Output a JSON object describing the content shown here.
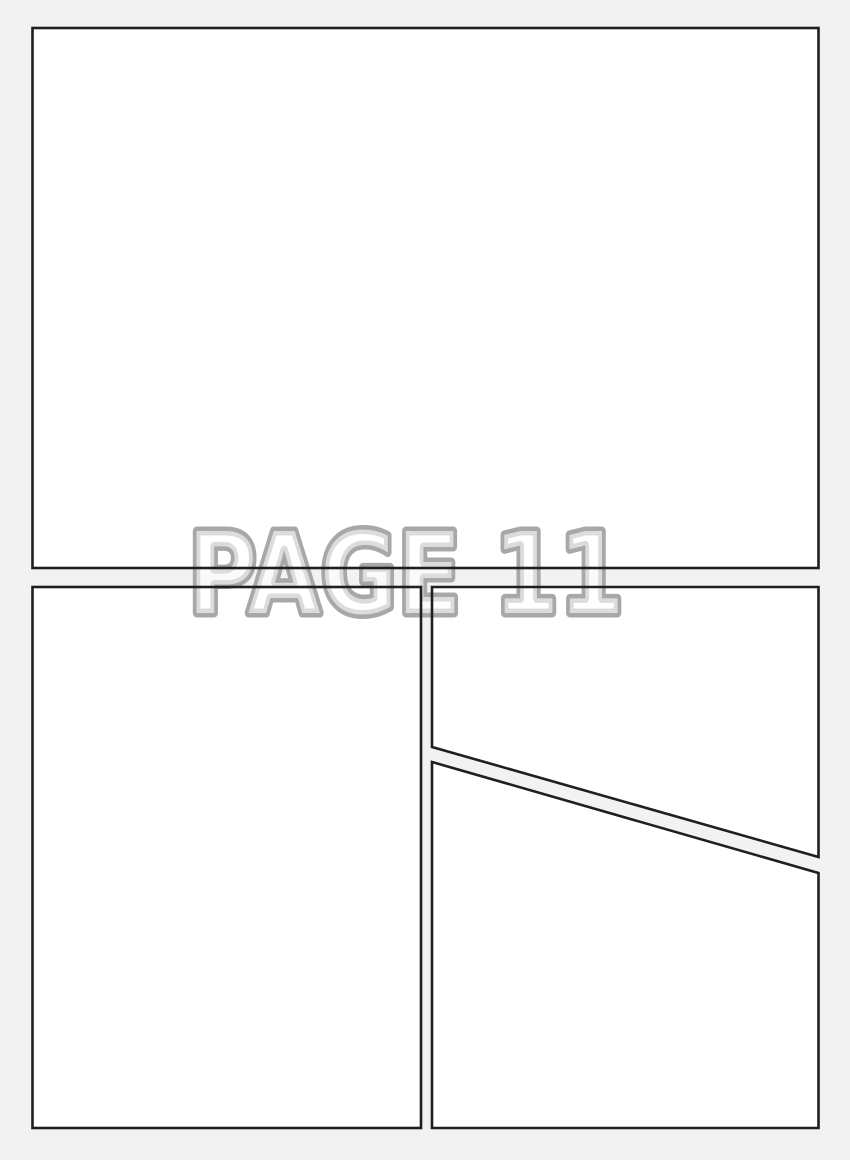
{
  "page": {
    "label": "PAGE 11",
    "colors": {
      "background": "#f2f2f2",
      "panel_fill": "#ffffff",
      "panel_border": "#1f1f1f",
      "label_fill": "#ffffff",
      "label_outline": "#a8a8a8"
    }
  }
}
